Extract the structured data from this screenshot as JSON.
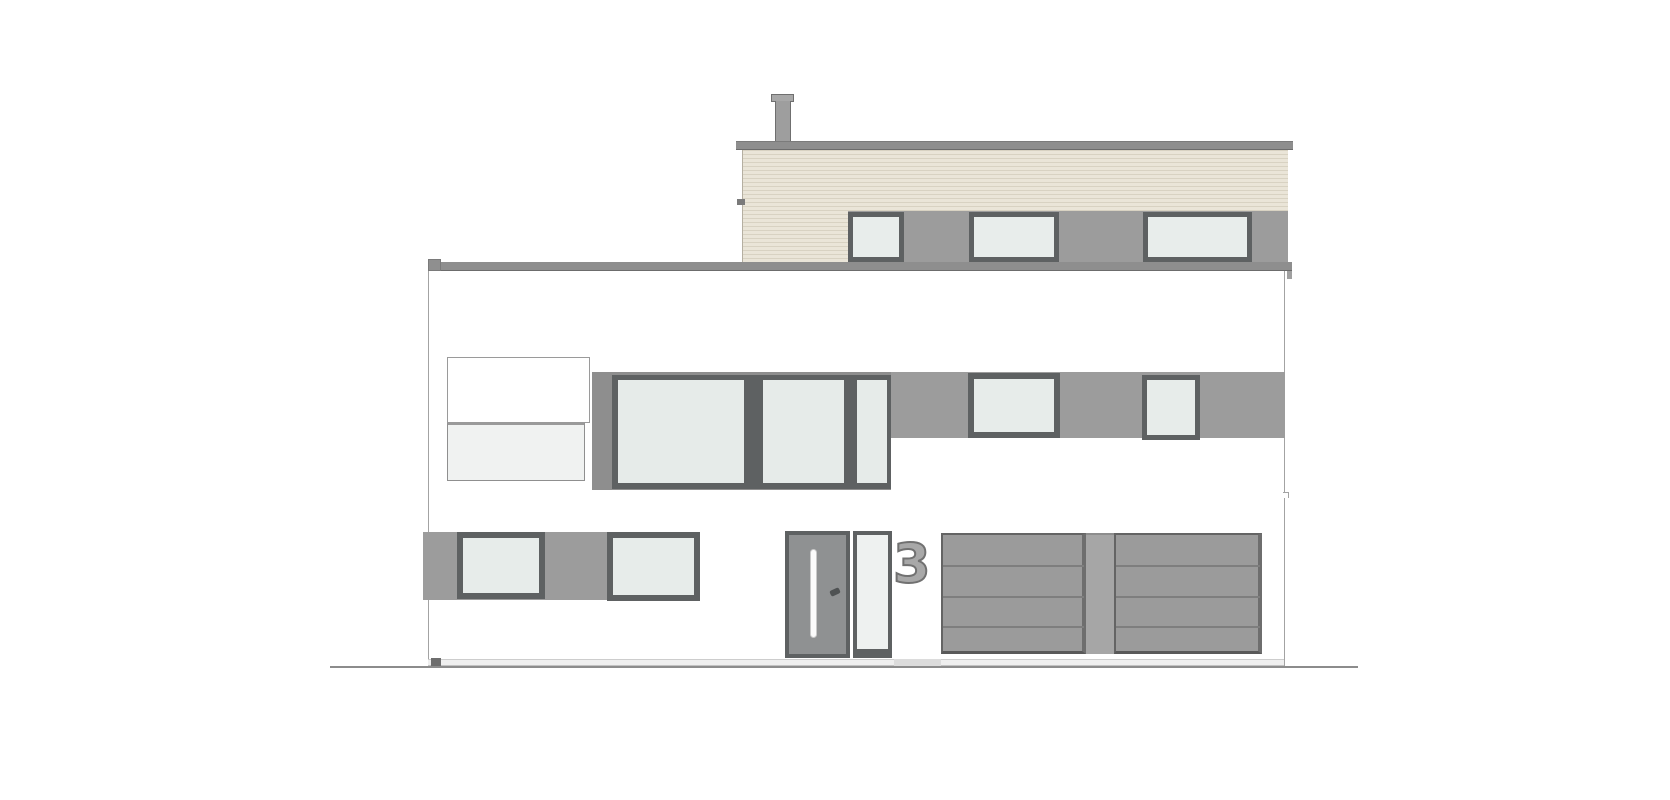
{
  "meta": {
    "title": "House front elevation drawing",
    "drawing_type": "architectural elevation",
    "storeys": 3
  },
  "house": {
    "number": "3"
  },
  "colors": {
    "background": "#ffffff",
    "wood_siding": "#eae5d8",
    "wood_siding_stripe": "#d8d2c2",
    "window_band_gray": "#9c9c9c",
    "window_surround_gray": "#8e8e8e",
    "window_frame_dark": "#5e6162",
    "glass": "#e7ecea",
    "roof_band": "#8e8e8e",
    "door_panel": "#8f9192",
    "garage_door": "#9b9b9b",
    "garage_seam": "#7e7e7e",
    "ground_line": "#8c8c8c",
    "house_number_fill": "#a8a8a8",
    "house_number_outline": "#717171"
  },
  "canvas": {
    "width": 1670,
    "height": 800,
    "background": "#ffffff"
  },
  "shapes": [
    {
      "name": "facade-wall",
      "interactable": false,
      "x": 428,
      "y": 262,
      "w": 857,
      "h": 398,
      "css": {
        "background": "#ffffff"
      }
    },
    {
      "name": "left-wall-line",
      "interactable": false,
      "x": 428,
      "y": 262,
      "w": 1,
      "h": 398,
      "css": {
        "background": "#a3a3a3"
      }
    },
    {
      "name": "right-wall-line",
      "interactable": false,
      "x": 1284,
      "y": 271,
      "w": 1,
      "h": 396,
      "css": {
        "background": "#a3a3a3"
      }
    },
    {
      "name": "right-wall-step",
      "interactable": false,
      "x": 1283,
      "y": 492,
      "w": 6,
      "h": 6,
      "css": {
        "background": "#ffffff",
        "borderTop": "1px solid #a3a3a3",
        "borderRight": "1px solid #a3a3a3"
      }
    },
    {
      "name": "chimney-cap",
      "interactable": false,
      "x": 771,
      "y": 94,
      "w": 23,
      "h": 8,
      "css": {
        "background": "#a8a8a8",
        "border": "1px solid #6f6f6f"
      }
    },
    {
      "name": "chimney-body",
      "interactable": false,
      "x": 775,
      "y": 101,
      "w": 16,
      "h": 41,
      "css": {
        "background": "#9e9e9e",
        "borderLeft": "1px solid #6f6f6f",
        "borderRight": "1px solid #6f6f6f"
      }
    },
    {
      "name": "attic-roof-band",
      "interactable": false,
      "x": 736,
      "y": 141,
      "w": 557,
      "h": 9,
      "css": {
        "background": "#8e8e8e",
        "borderTop": "1px solid #7b7b7b",
        "borderBottom": "1px solid #6c6c6c"
      }
    },
    {
      "name": "attic-wood-siding",
      "interactable": false,
      "x": 742,
      "y": 150,
      "w": 546,
      "h": 112,
      "css": {
        "background": "repeating-linear-gradient(to bottom, #d8d2c2 0px, #d8d2c2 1px, #eae5d8 1px, #eae5d8 4px)",
        "borderLeft": "1px solid #b5afa1"
      }
    },
    {
      "name": "siding-edge-tick",
      "interactable": false,
      "x": 737,
      "y": 199,
      "w": 8,
      "h": 6,
      "css": {
        "background": "#7a7a7a"
      }
    },
    {
      "name": "attic-window-band",
      "interactable": false,
      "x": 848,
      "y": 211,
      "w": 440,
      "h": 51,
      "css": {
        "background": "#9c9c9c"
      }
    },
    {
      "name": "attic-window-1",
      "interactable": false,
      "x": 848,
      "y": 212,
      "w": 56,
      "h": 50,
      "css": {
        "background": "#e8edeb",
        "border": "5px solid #5e6162"
      }
    },
    {
      "name": "attic-window-2",
      "interactable": false,
      "x": 969,
      "y": 212,
      "w": 90,
      "h": 50,
      "css": {
        "background": "#e8edeb",
        "border": "5px solid #5e6162"
      }
    },
    {
      "name": "attic-window-3",
      "interactable": false,
      "x": 1143,
      "y": 212,
      "w": 109,
      "h": 50,
      "css": {
        "background": "#e8edeb",
        "border": "5px solid #5e6162"
      }
    },
    {
      "name": "lower-roof-parapet-band",
      "interactable": false,
      "x": 428,
      "y": 262,
      "w": 864,
      "h": 9,
      "css": {
        "background": "#8e8e8e",
        "borderBottom": "1px solid #6c6c6c"
      }
    },
    {
      "name": "parapet-left-notch",
      "interactable": false,
      "x": 428,
      "y": 259,
      "w": 13,
      "h": 12,
      "css": {
        "background": "#8f8f8f",
        "border": "1px solid #7a7a7a"
      }
    },
    {
      "name": "parapet-right-tail",
      "interactable": false,
      "x": 1287,
      "y": 271,
      "w": 5,
      "h": 8,
      "css": {
        "background": "#a0a0a0"
      }
    },
    {
      "name": "balcony-box",
      "interactable": false,
      "x": 447,
      "y": 357,
      "w": 143,
      "h": 66,
      "css": {
        "background": "#ffffff",
        "border": "1px solid #9a9a9a"
      }
    },
    {
      "name": "balcony-glass-balustrade",
      "interactable": false,
      "x": 447,
      "y": 422,
      "w": 138,
      "h": 59,
      "css": {
        "background": "#f0f2f1",
        "border": "1px solid #8f8f8f",
        "borderTop": "3px solid #9a9a9a"
      }
    },
    {
      "name": "mid-window-band-right",
      "interactable": false,
      "x": 891,
      "y": 372,
      "w": 394,
      "h": 66,
      "css": {
        "background": "#9c9c9c"
      }
    },
    {
      "name": "mid-window-group-surround",
      "interactable": false,
      "x": 592,
      "y": 372,
      "w": 299,
      "h": 118,
      "css": {
        "background": "#8e8e8e"
      }
    },
    {
      "name": "mid-window-group-frame",
      "interactable": false,
      "x": 612,
      "y": 375,
      "w": 279,
      "h": 114,
      "css": {
        "background": "#5e6162"
      }
    },
    {
      "name": "mid-window-glass-large",
      "interactable": false,
      "x": 618,
      "y": 380,
      "w": 126,
      "h": 103,
      "css": {
        "background": "#e6ebe9"
      }
    },
    {
      "name": "mid-window-glass-center",
      "interactable": false,
      "x": 763,
      "y": 380,
      "w": 81,
      "h": 103,
      "css": {
        "background": "#e6ebe9"
      }
    },
    {
      "name": "mid-window-glass-narrow",
      "interactable": false,
      "x": 857,
      "y": 380,
      "w": 30,
      "h": 103,
      "css": {
        "background": "#e6ebe9"
      }
    },
    {
      "name": "mid-window-medium",
      "interactable": false,
      "x": 968,
      "y": 373,
      "w": 92,
      "h": 65,
      "css": {
        "background": "#e7ecea",
        "border": "6px solid #5e6162"
      }
    },
    {
      "name": "mid-window-small",
      "interactable": false,
      "x": 1142,
      "y": 375,
      "w": 58,
      "h": 65,
      "css": {
        "background": "#e7ecea",
        "border": "5px solid #5e6162"
      }
    },
    {
      "name": "ground-floor-band-left",
      "interactable": false,
      "x": 423,
      "y": 532,
      "w": 277,
      "h": 68,
      "css": {
        "background": "#9c9c9c"
      }
    },
    {
      "name": "ground-floor-window-1",
      "interactable": false,
      "x": 457,
      "y": 532,
      "w": 88,
      "h": 67,
      "css": {
        "background": "#e7ecea",
        "border": "6px solid #5e6162"
      }
    },
    {
      "name": "ground-floor-window-2",
      "interactable": false,
      "x": 607,
      "y": 532,
      "w": 93,
      "h": 69,
      "css": {
        "background": "#e7ecea",
        "border": "6px solid #5e6162"
      }
    },
    {
      "name": "entry-door",
      "interactable": false,
      "x": 785,
      "y": 531,
      "w": 65,
      "h": 127,
      "css": {
        "background": "#8f9192",
        "border": "4px solid #5e6162"
      }
    },
    {
      "name": "door-handle-bar",
      "interactable": false,
      "x": 810,
      "y": 549,
      "w": 7,
      "h": 89,
      "css": {
        "background": "#fbfbfb",
        "border": "1px solid #c9c9c9",
        "borderRadius": "4px"
      }
    },
    {
      "name": "door-lock-mark",
      "interactable": false,
      "x": 830,
      "y": 589,
      "w": 10,
      "h": 6,
      "css": {
        "background": "#4f5253",
        "borderRadius": "2px"
      },
      "rot": -25
    },
    {
      "name": "door-sidelight",
      "interactable": false,
      "x": 853,
      "y": 531,
      "w": 39,
      "h": 127,
      "css": {
        "background": "#eef1f0",
        "border": "4px solid #5e6162",
        "borderBottom": "9px solid #5e6162"
      }
    },
    {
      "name": "garage-door-left",
      "interactable": false,
      "x": 941,
      "y": 533,
      "w": 145,
      "h": 121,
      "css": {
        "background": "#9b9b9b",
        "border": "2px solid #646464",
        "borderRight": "4px solid #6e6e6e",
        "borderBottom": "3px solid #595959"
      }
    },
    {
      "name": "garage-pillar",
      "interactable": false,
      "x": 1086,
      "y": 533,
      "w": 28,
      "h": 121,
      "css": {
        "background": "#a6a6a6",
        "borderTop": "2px solid #8d8d8d"
      }
    },
    {
      "name": "garage-door-right",
      "interactable": false,
      "x": 1114,
      "y": 533,
      "w": 148,
      "h": 121,
      "css": {
        "background": "#9b9b9b",
        "border": "2px solid #646464",
        "borderRight": "4px solid #6e6e6e",
        "borderBottom": "3px solid #595959"
      }
    },
    {
      "name": "garage-left-seam-1",
      "interactable": false,
      "x": 943,
      "y": 565,
      "w": 141,
      "h": 2,
      "css": {
        "background": "#7e7e7e"
      }
    },
    {
      "name": "garage-left-seam-2",
      "interactable": false,
      "x": 943,
      "y": 596,
      "w": 141,
      "h": 2,
      "css": {
        "background": "#7e7e7e"
      }
    },
    {
      "name": "garage-left-seam-3",
      "interactable": false,
      "x": 943,
      "y": 626,
      "w": 141,
      "h": 2,
      "css": {
        "background": "#7e7e7e"
      }
    },
    {
      "name": "garage-right-seam-1",
      "interactable": false,
      "x": 1116,
      "y": 565,
      "w": 144,
      "h": 2,
      "css": {
        "background": "#7e7e7e"
      }
    },
    {
      "name": "garage-right-seam-2",
      "interactable": false,
      "x": 1116,
      "y": 596,
      "w": 144,
      "h": 2,
      "css": {
        "background": "#7e7e7e"
      }
    },
    {
      "name": "garage-right-seam-3",
      "interactable": false,
      "x": 1116,
      "y": 626,
      "w": 144,
      "h": 2,
      "css": {
        "background": "#7e7e7e"
      }
    },
    {
      "name": "plinth-strip",
      "interactable": false,
      "x": 428,
      "y": 659,
      "w": 856,
      "h": 7,
      "css": {
        "background": "#efefef",
        "borderTop": "1px solid #cdcdcd",
        "borderBottom": "1px solid #c2c2c2"
      }
    },
    {
      "name": "doormat-step",
      "interactable": false,
      "x": 894,
      "y": 659,
      "w": 47,
      "h": 7,
      "css": {
        "background": "#dcdcdc"
      }
    },
    {
      "name": "plinth-block",
      "interactable": false,
      "x": 431,
      "y": 658,
      "w": 10,
      "h": 9,
      "css": {
        "background": "#6e6e6e"
      }
    },
    {
      "name": "ground-line",
      "interactable": false,
      "x": 330,
      "y": 666,
      "w": 1028,
      "h": 2,
      "css": {
        "background": "#8c8c8c"
      }
    },
    {
      "name": "house-number",
      "interactable": false,
      "x": 893,
      "y": 538,
      "w": 42,
      "h": 54,
      "type": "text",
      "bind": "house.number",
      "css": {
        "color": "#a8a8a8"
      }
    }
  ]
}
